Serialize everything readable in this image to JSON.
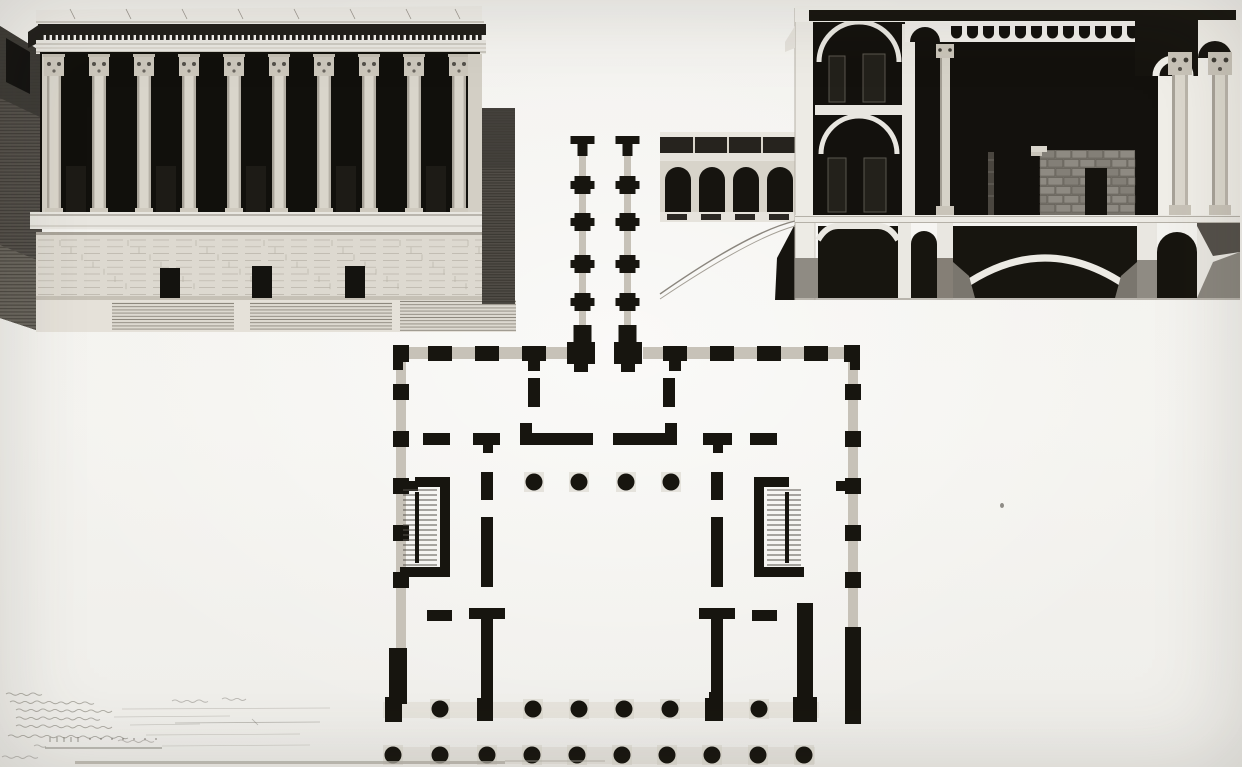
{
  "artwork": {
    "kind": "monochrome architectural drawing plate (ink and wash), photographed",
    "views": [
      {
        "id": "elevation",
        "label": "temple-front elevation on podium"
      },
      {
        "id": "section",
        "label": "transverse building section"
      },
      {
        "id": "plan",
        "label": "ground plan with porticoes"
      }
    ],
    "handwriting_legible": false
  },
  "colors": {
    "paper": "#f2f1ed",
    "paperBright": "#f5f4f0",
    "ink": "#17150f",
    "darkWash": "#13110d",
    "panelDark": "#201e19",
    "stone": "#d9d5cb",
    "stoneLight": "#e8e6e0",
    "stoneShade": "#a8a399",
    "infill": "#c7c2b8",
    "midGray": "#8f8b83",
    "hatchDark": "#534f49",
    "lineFaint": "#8b877e"
  },
  "elevation": {
    "column_centers": [
      54,
      99,
      144,
      189,
      234,
      279,
      324,
      369,
      414,
      459
    ],
    "column_count": 10,
    "bay_door_mids": [
      76,
      166,
      256,
      346,
      436
    ],
    "podium_doors": [
      {
        "x": 160,
        "y": 268,
        "w": 20,
        "h": 30
      },
      {
        "x": 252,
        "y": 266,
        "w": 20,
        "h": 32
      },
      {
        "x": 345,
        "y": 266,
        "w": 20,
        "h": 32
      }
    ],
    "roof_tick_xs": [
      70,
      126,
      182,
      238,
      294,
      350,
      406,
      455
    ],
    "step_groups": [
      {
        "x": 112,
        "y": 302,
        "w": 122,
        "h": 28
      },
      {
        "x": 250,
        "y": 302,
        "w": 142,
        "h": 28
      },
      {
        "x": 400,
        "y": 300,
        "w": 116,
        "h": 31
      }
    ]
  },
  "section": {
    "wing_arch_xs": [
      12,
      46,
      80,
      114
    ],
    "wing_arch_w": 26,
    "corbels": {
      "x0": 298,
      "x1": 523,
      "step": 16,
      "y": 26,
      "w": 11,
      "h": 7
    },
    "upper_windows": [
      {
        "x": 176,
        "y": 56,
        "w": 16,
        "h": 46
      },
      {
        "x": 210,
        "y": 54,
        "w": 22,
        "h": 48
      },
      {
        "x": 175,
        "y": 158,
        "w": 18,
        "h": 54
      },
      {
        "x": 211,
        "y": 158,
        "w": 22,
        "h": 54
      }
    ],
    "masonry": {
      "x": 387,
      "y": 150,
      "w": 95,
      "h": 65,
      "block_w": 16,
      "block_h": 9
    },
    "hall_column_x": 292,
    "loggia_column_xs": [
      527,
      567
    ]
  },
  "plan": {
    "corridor": {
      "left_cx": 217.5,
      "right_cx": 262.5,
      "pier_ys": [
        56,
        93,
        135,
        173
      ],
      "top_y": 16,
      "infill_w": 7
    },
    "top_wall": {
      "pier_centers": [
        75,
        122,
        169,
        310,
        357,
        404,
        451
      ],
      "big_pier_centers": [
        216,
        263
      ],
      "stub_down_centers": [
        169,
        310
      ],
      "y": 225
    },
    "side_wall_pier_ys": [
      272,
      319,
      366,
      413,
      460
    ],
    "side_wall_stub_ys": [
      366
    ],
    "courtyard_dots_x": [
      169,
      214,
      261,
      306
    ],
    "courtyard_dots_y": 362,
    "row1_y": 589,
    "row1": [
      {
        "type": "pier",
        "x": 20,
        "y": 577,
        "w": 17,
        "h": 25
      },
      {
        "type": "col",
        "cx": 75
      },
      {
        "type": "sq",
        "x": 112,
        "y": 578,
        "w": 16,
        "h": 23
      },
      {
        "type": "col",
        "cx": 168
      },
      {
        "type": "col",
        "cx": 214
      },
      {
        "type": "col",
        "cx": 259
      },
      {
        "type": "col",
        "cx": 305
      },
      {
        "type": "sq",
        "x": 340,
        "y": 578,
        "w": 18,
        "h": 23
      },
      {
        "type": "col",
        "cx": 394
      },
      {
        "type": "pier",
        "x": 428,
        "y": 577,
        "w": 24,
        "h": 25
      }
    ],
    "row2_xs": [
      28,
      75,
      122,
      167,
      212,
      257,
      302,
      347,
      393,
      439
    ],
    "row2_y": 635,
    "column_radius": 8.5,
    "band_walls": [
      {
        "x": 58,
        "y": 313,
        "w": 27,
        "h": 12
      },
      {
        "x": 108,
        "y": 313,
        "w": 27,
        "h": 12,
        "stubDownX": 118
      },
      {
        "x": 155,
        "y": 313,
        "w": 73,
        "h": 12,
        "stubUpX": 155
      },
      {
        "x": 248,
        "y": 313,
        "w": 64,
        "h": 12,
        "stubUpX": 300
      },
      {
        "x": 338,
        "y": 313,
        "w": 29,
        "h": 12,
        "stubDownX": 348
      },
      {
        "x": 385,
        "y": 313,
        "w": 27,
        "h": 12
      }
    ],
    "band_piers": [
      {
        "x": 163,
        "y": 258,
        "w": 12,
        "h": 29
      },
      {
        "x": 298,
        "y": 258,
        "w": 12,
        "h": 29
      }
    ],
    "partition_xs": [
      116,
      346
    ],
    "partition_segs": [
      {
        "y": 352,
        "h": 28
      },
      {
        "y": 397,
        "h": 70
      },
      {
        "y": 488,
        "h": 90,
        "arm": true
      }
    ],
    "mid_dashes": [
      {
        "x": 62,
        "y": 490,
        "w": 25,
        "h": 11
      },
      {
        "x": 387,
        "y": 490,
        "w": 25,
        "h": 11
      }
    ],
    "stairs": [
      {
        "wallX": 75,
        "armTop": [
          50,
          357,
          35,
          10
        ],
        "armBot": [
          35,
          447,
          50,
          10
        ],
        "stepX0": 38,
        "stepX1": 72,
        "stringerX": 50
      },
      {
        "wallX": 389,
        "armTop": [
          389,
          357,
          35,
          10
        ],
        "armBot": [
          389,
          447,
          50,
          10
        ],
        "stepX0": 402,
        "stepX1": 436,
        "stringerX": 420
      }
    ],
    "steps_y0": 370,
    "steps_y1": 445
  },
  "legend": {
    "handwriting_legible": false,
    "lines": [
      {
        "x": 6,
        "y": 9,
        "len": 46
      },
      {
        "x": 10,
        "y": 17,
        "len": 88
      },
      {
        "x": 16,
        "y": 25,
        "len": 96,
        "ext": 330
      },
      {
        "x": 16,
        "y": 33,
        "len": 88,
        "ext": 230
      },
      {
        "x": 16,
        "y": 41,
        "len": 104,
        "ext": 200
      },
      {
        "x": 8,
        "y": 51,
        "len": 128,
        "ext": 300
      }
    ],
    "extra_marks": [
      {
        "x": 172,
        "y": 16,
        "len": 40
      },
      {
        "x": 222,
        "y": 14,
        "len": 26
      },
      {
        "x": 34,
        "y": 61,
        "len": 16
      },
      {
        "x": 118,
        "y": 56,
        "len": 44
      },
      {
        "x": 2,
        "y": 72,
        "len": 40
      }
    ],
    "scale_bar": {
      "tick_x0": 50,
      "tick_x1": 78,
      "tick_step": 7,
      "dot_x0": 90,
      "dot_x1": 160,
      "dot_step": 11,
      "line_x0": 45,
      "line_x1": 162,
      "line_y": 63,
      "ext_x1": 310,
      "arrow_line": {
        "x0": 175,
        "x1": 320,
        "y": 38
      }
    }
  }
}
